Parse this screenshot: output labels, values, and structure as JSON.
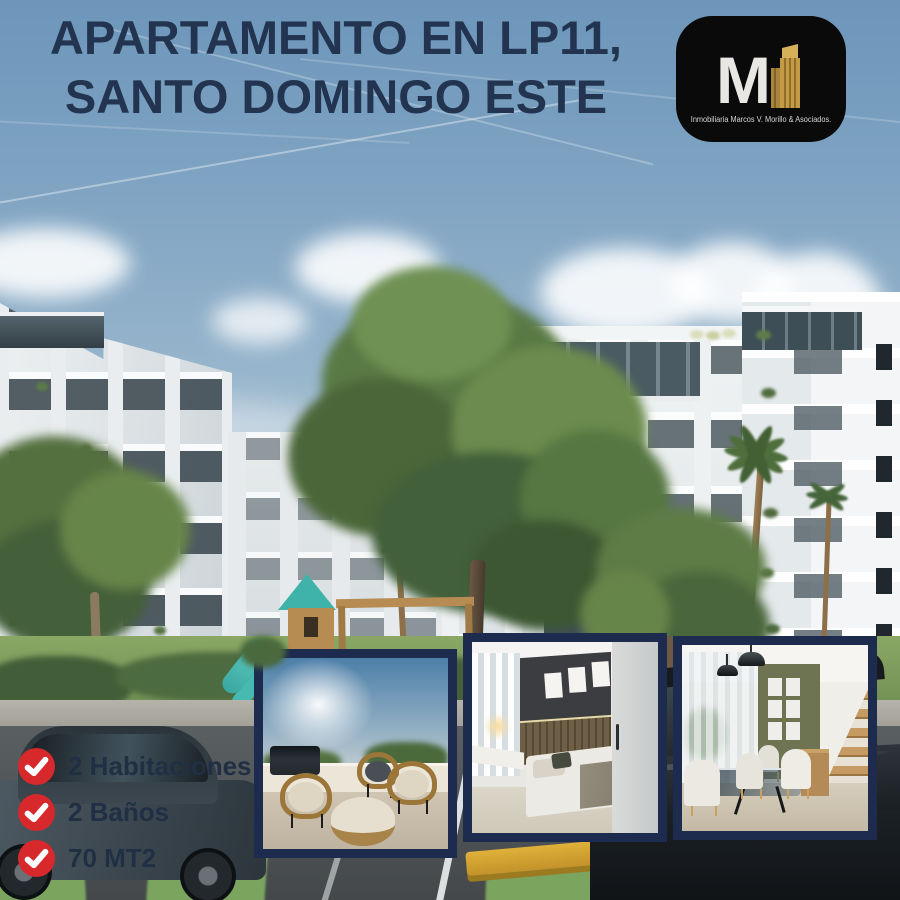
{
  "poster": {
    "title": {
      "line1": "APARTAMENTO EN LP11,",
      "line2": "SANTO DOMINGO ESTE",
      "color": "#22344f"
    },
    "logo": {
      "monogram": "M",
      "caption": "Inmobiliaria Marcos V. Morillo & Asociados.",
      "bg_color": "#0a0a0b",
      "monogram_color": "#e9e7e3",
      "building_gold": "#c49a45"
    },
    "features": {
      "icon": "check-icon",
      "icon_color": "#d7282c",
      "text_color": "#212f45",
      "items": [
        {
          "label": "2 Habitaciones"
        },
        {
          "label": "2 Baños"
        },
        {
          "label": "70 MT2"
        }
      ]
    },
    "gallery": {
      "frame_color": "#1d2c4e",
      "photos": [
        {
          "name": "rooftop-terrace",
          "alt": "Terraza en azotea con sillas de ratán"
        },
        {
          "name": "bedroom",
          "alt": "Habitación con cama y cuadros"
        },
        {
          "name": "dining-room",
          "alt": "Comedor con mesa de cristal y escalera"
        }
      ]
    },
    "scene": {
      "alt": "Render 3D de complejo de apartamentos blanco con árboles, parque infantil y parqueo"
    }
  }
}
